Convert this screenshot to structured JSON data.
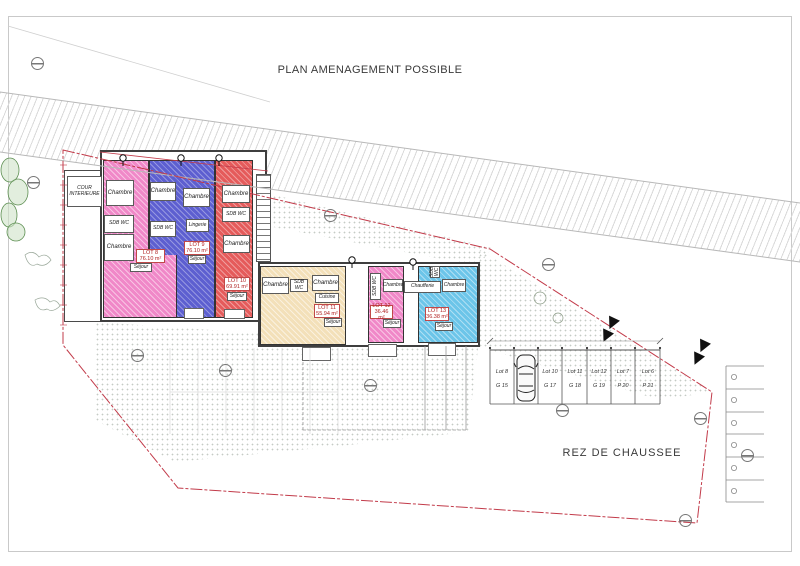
{
  "title": "PLAN AMENAGEMENT POSSIBLE",
  "floor": "REZ DE CHAUSSEE",
  "annex": {
    "cour": "COUR INTERIEURE"
  },
  "chaufferie": "Chaufferie",
  "lot8": {
    "chambre1": "Chambre",
    "sdb": "SDB WC",
    "chambre2": "Chambre",
    "name": "LOT 8",
    "area": "76.10 m²",
    "sejour": "Séjour"
  },
  "lot9": {
    "chambre1": "Chambre",
    "sdb": "SDB WC",
    "chambre2": "Chambre",
    "lingerie": "Lingerie",
    "name": "LOT 9",
    "area": "76.10 m²",
    "sejour": "Séjour"
  },
  "lot10": {
    "chambre1": "Chambre",
    "sdb": "SDB WC",
    "chambre2": "Chambre",
    "name": "LOT 10",
    "area": "69.91 m²",
    "sejour": "Séjour"
  },
  "lot11": {
    "chambre1": "Chambre",
    "sdb": "SDB WC",
    "chambre2": "Chambre",
    "cuisine": "Cuisine",
    "name": "LOT 11",
    "area": "55.94 m²",
    "sejour": "Séjour"
  },
  "lot12": {
    "sdb": "SDB WC",
    "chambre": "Chambre",
    "name": "LOT 12",
    "area": "36.46 m²",
    "sejour": "Séjour"
  },
  "lot13": {
    "sdb": "SDB WC",
    "chambre": "Chambre",
    "name": "LOT 13",
    "area": "36.38 m²",
    "sejour": "Séjour"
  },
  "parking": {
    "stalls": [
      {
        "lot": "Lot 8",
        "bay": "G 15"
      },
      {
        "lot": "Lot 9",
        "bay": "G 16"
      },
      {
        "lot": "Lot 10",
        "bay": "G 17"
      },
      {
        "lot": "Lot 11",
        "bay": "G 18"
      },
      {
        "lot": "Lot 12",
        "bay": "G 19"
      },
      {
        "lot": "Lot 7",
        "bay": "P 20"
      },
      {
        "lot": "Lot 6",
        "bay": "P 21"
      }
    ]
  },
  "colors": {
    "pink": "#f088c8",
    "blue": "#5d5fd0",
    "red": "#e55b5b",
    "beige": "#f3e0b9",
    "cyan": "#6cc5e9",
    "boundary": "#c23b4a"
  }
}
